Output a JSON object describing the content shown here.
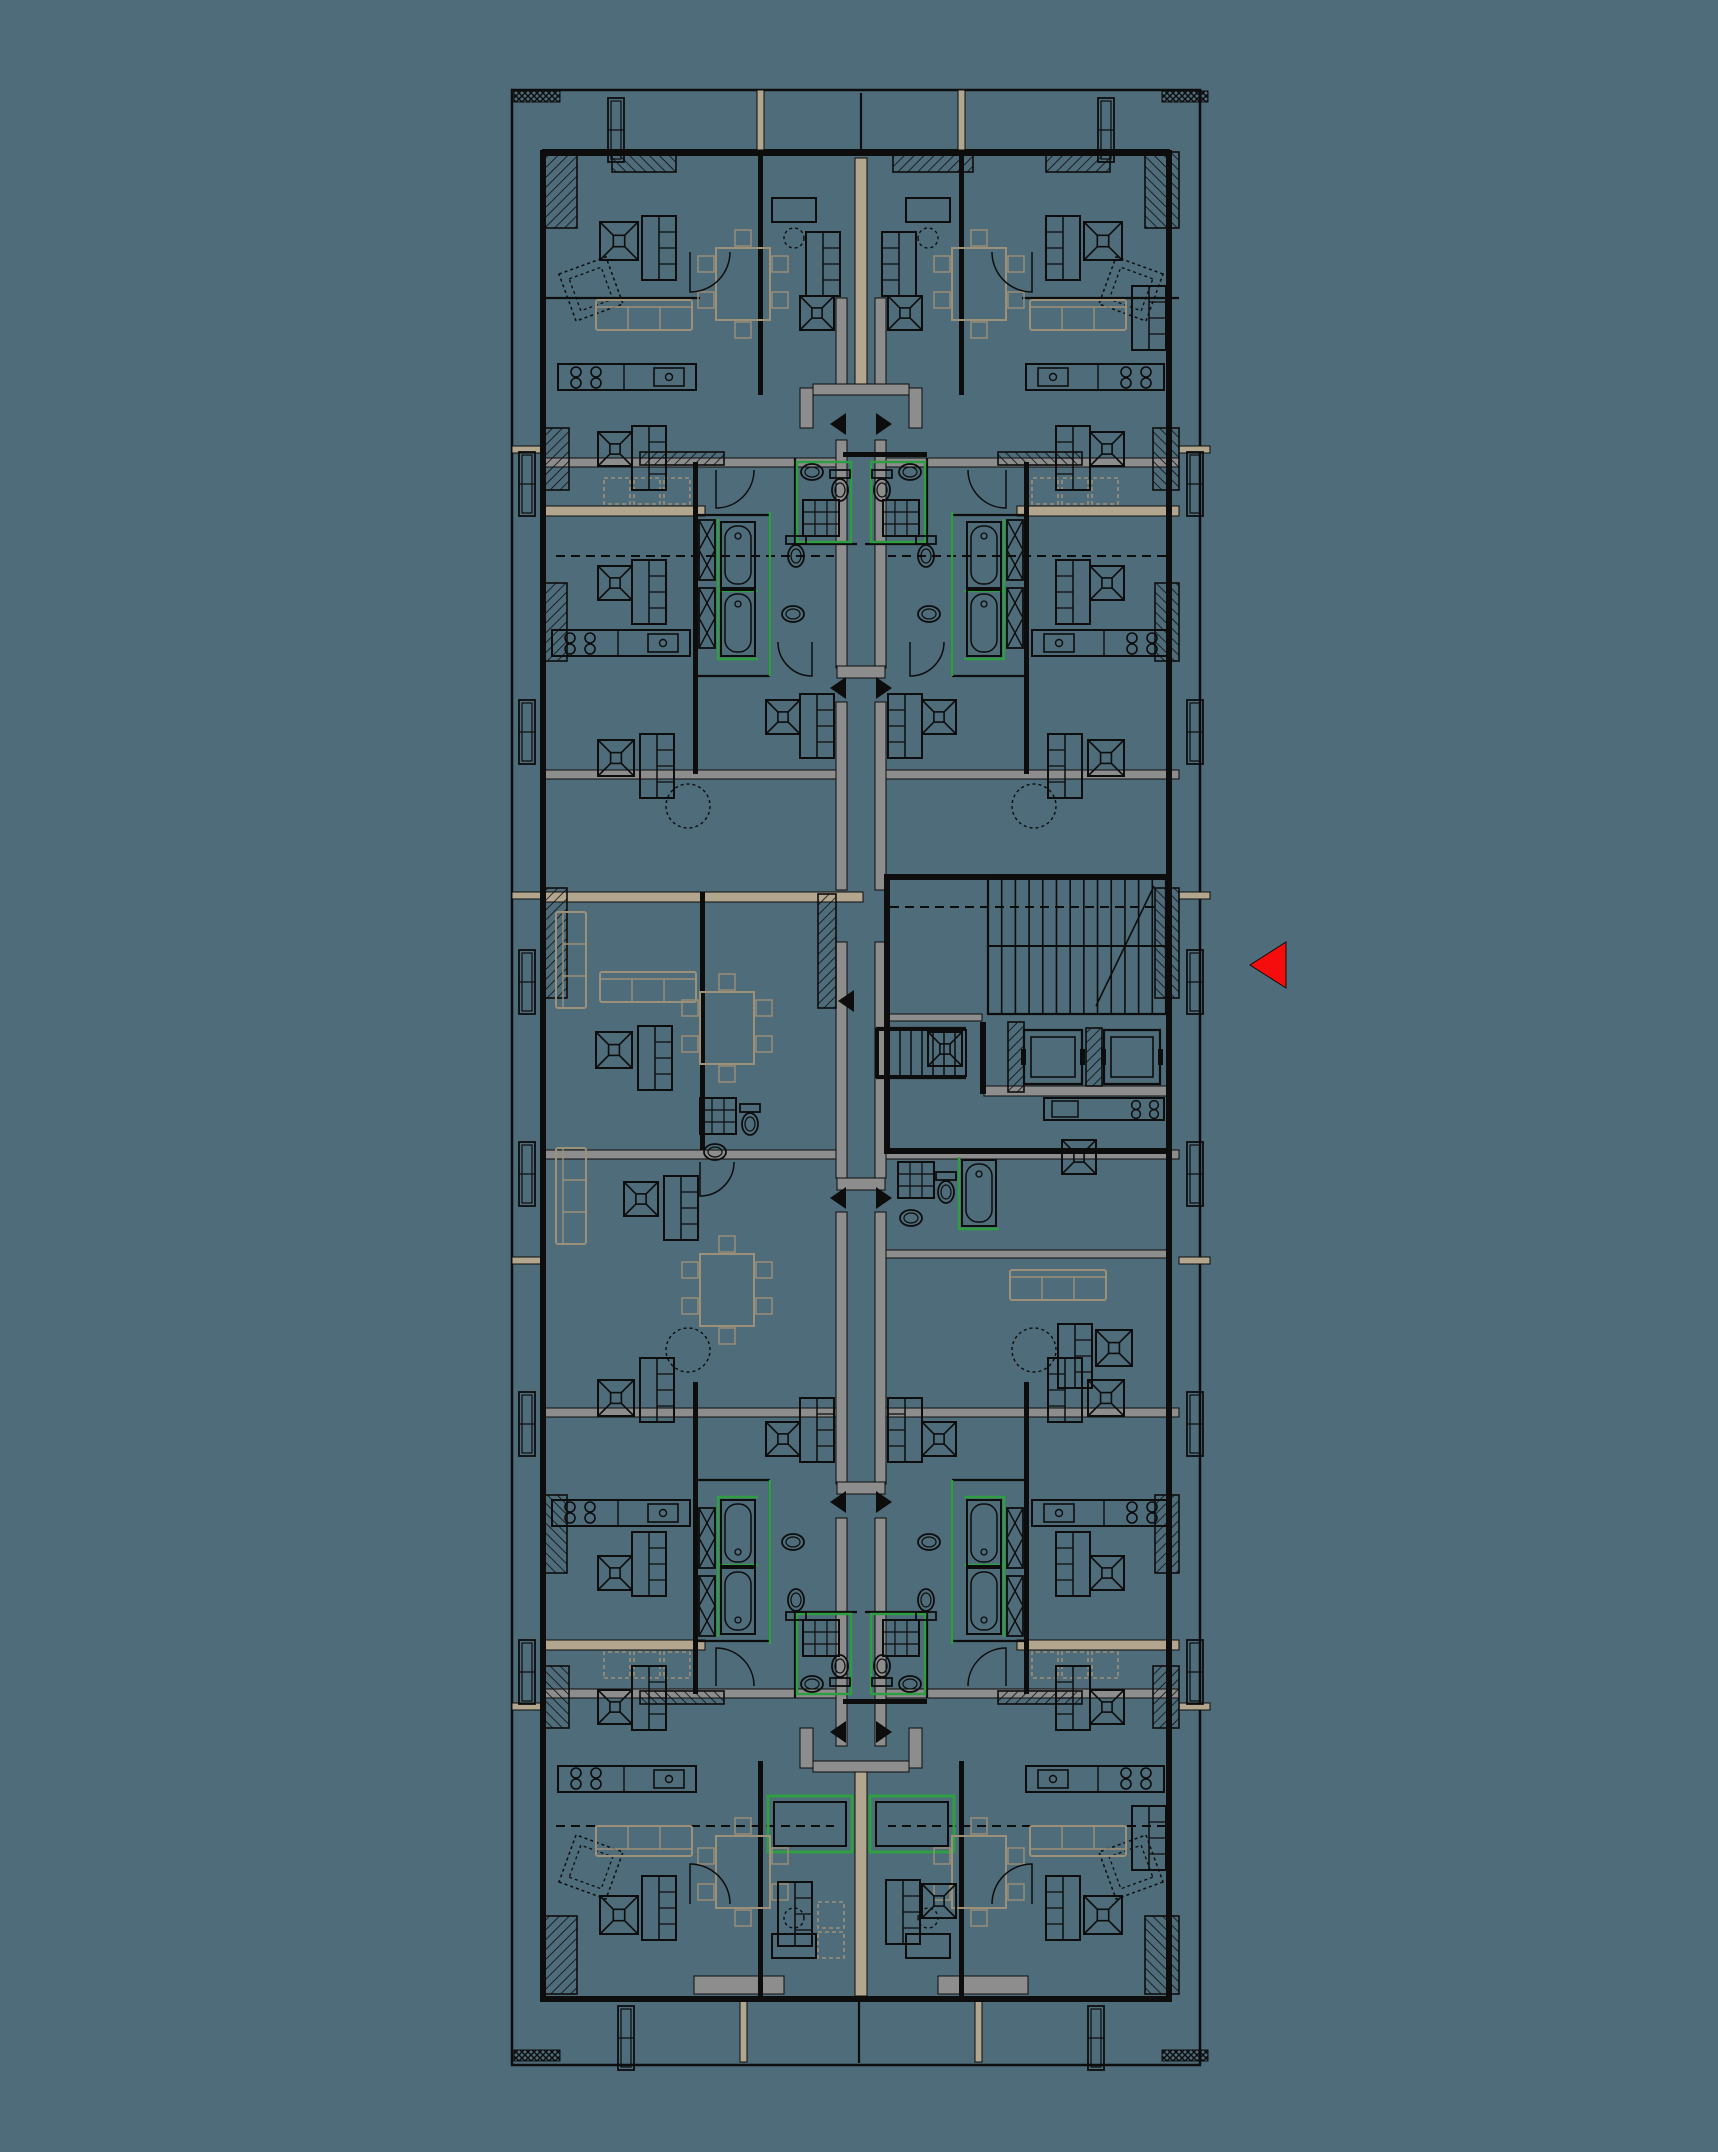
{
  "canvas": {
    "width": 1718,
    "height": 2152,
    "background": "#4e6c7a"
  },
  "palette": {
    "line": "#0d0d0d",
    "wall_gray": "#8d8d8d",
    "wall_tan": "#b2a68e",
    "furniture_tan": "#9d9078",
    "accent_green": "#2f9e43",
    "marker_red": "#f50d0d"
  },
  "mirror": {
    "axis_x": 861,
    "axis_y": 1078,
    "width2": 1722,
    "height2": 2156
  },
  "building": {
    "outer": [
      512,
      90,
      688,
      1975
    ],
    "inner": [
      543,
      150,
      626,
      1848
    ]
  },
  "walls": {
    "black": [
      [
        543,
        150,
        626,
        6
      ],
      [
        543,
        1996,
        626,
        6
      ],
      [
        540,
        150,
        6,
        1852
      ],
      [
        1166,
        150,
        6,
        1852
      ],
      [
        693,
        462,
        5,
        312,
        "4"
      ],
      [
        758,
        155,
        5,
        240,
        "4"
      ],
      [
        843,
        452,
        84,
        5,
        "y"
      ],
      [
        886,
        874,
        282,
        6
      ],
      [
        886,
        1148,
        282,
        6
      ],
      [
        884,
        874,
        6,
        280
      ],
      [
        980,
        1022,
        6,
        72
      ],
      [
        700,
        892,
        5,
        258
      ]
    ],
    "gray": [
      [
        543,
        458,
        300,
        9,
        "4"
      ],
      [
        543,
        770,
        300,
        9,
        "x"
      ],
      [
        543,
        1150,
        300,
        9,
        "x"
      ],
      [
        543,
        1408,
        300,
        9,
        "x"
      ],
      [
        836,
        298,
        11,
        90,
        "x"
      ],
      [
        836,
        440,
        11,
        228,
        "x"
      ],
      [
        836,
        702,
        11,
        188,
        "x"
      ],
      [
        836,
        942,
        11,
        236,
        "x"
      ],
      [
        836,
        1212,
        11,
        272,
        "x"
      ],
      [
        836,
        1518,
        11,
        228,
        "x"
      ],
      [
        800,
        388,
        13,
        40,
        "4"
      ],
      [
        813,
        384,
        96,
        11,
        "y"
      ],
      [
        984,
        1086,
        184,
        10
      ],
      [
        886,
        1014,
        96,
        7
      ],
      [
        886,
        1250,
        282,
        8
      ],
      [
        694,
        1976,
        90,
        18
      ],
      [
        938,
        1976,
        90,
        18
      ],
      [
        837,
        666,
        48,
        12
      ],
      [
        837,
        1178,
        48,
        12
      ],
      [
        837,
        1482,
        48,
        12
      ]
    ],
    "tan": [
      [
        855,
        158,
        12,
        230
      ],
      [
        855,
        1772,
        12,
        224
      ],
      [
        543,
        506,
        162,
        10,
        "4"
      ],
      [
        543,
        892,
        320,
        10
      ],
      [
        512,
        446,
        31,
        7,
        "4"
      ],
      [
        512,
        892,
        31,
        7,
        "4"
      ],
      [
        757,
        90,
        7,
        60,
        "x"
      ],
      [
        740,
        1998,
        7,
        64,
        "x"
      ]
    ],
    "hatched": [
      [
        543,
        152,
        34,
        76,
        "x"
      ],
      [
        543,
        428,
        26,
        62,
        "4"
      ],
      [
        543,
        583,
        24,
        78,
        "4"
      ],
      [
        543,
        888,
        24,
        110,
        "x"
      ],
      [
        543,
        1916,
        34,
        78,
        "x"
      ],
      [
        640,
        452,
        84,
        13,
        "4"
      ],
      [
        893,
        152,
        80,
        20
      ],
      [
        1046,
        152,
        64,
        20,
        "x"
      ],
      [
        1008,
        1022,
        16,
        70
      ],
      [
        1086,
        1028,
        16,
        58
      ],
      [
        818,
        894,
        18,
        114
      ]
    ],
    "ticks": [
      [
        514,
        91,
        46,
        11,
        "x"
      ],
      [
        514,
        2050,
        46,
        11,
        "x"
      ]
    ],
    "lines": [
      [
        543,
        298,
        700,
        298,
        "x"
      ],
      [
        795,
        458,
        795,
        544,
        "4"
      ],
      [
        795,
        544,
        857,
        544,
        "4"
      ],
      [
        698,
        515,
        770,
        515,
        "4"
      ],
      [
        770,
        515,
        770,
        676,
        "4"
      ],
      [
        698,
        676,
        770,
        676,
        "4"
      ],
      [
        876,
        1028,
        966,
        1028
      ],
      [
        876,
        1078,
        966,
        1078
      ],
      [
        876,
        1028,
        876,
        1078
      ],
      [
        861,
        93,
        861,
        150
      ],
      [
        859,
        2002,
        859,
        2063
      ]
    ],
    "dashed": [
      [
        556,
        556,
        834,
        556,
        "x"
      ],
      [
        556,
        1826,
        834,
        1826,
        "x"
      ],
      [
        890,
        907,
        1160,
        907
      ]
    ]
  },
  "green": {
    "rooms": [
      [
        797,
        462,
        54,
        80,
        "4"
      ]
    ],
    "lines": [
      [
        770,
        512,
        770,
        676,
        "4"
      ]
    ],
    "loggias": [
      [
        768,
        1796,
        84,
        56
      ],
      [
        870,
        1796,
        84,
        56
      ]
    ]
  },
  "core": {
    "stair_main": {
      "x": 988,
      "y": 878,
      "w": 178,
      "h": 136,
      "treads": 12
    },
    "stair_small": {
      "x": 878,
      "y": 1030,
      "w": 88,
      "h": 46,
      "treads": 7
    },
    "elevators": [
      [
        1024,
        1030,
        58,
        54
      ],
      [
        1104,
        1030,
        56,
        54
      ]
    ]
  },
  "arrows": {
    "pairs_y": [
      424,
      688,
      1198,
      1502,
      1732
    ],
    "single": {
      "x": 846,
      "y": 1001
    },
    "half_w": 16,
    "half_h": 11,
    "cx": 861,
    "inner_gap": 15
  },
  "view_marker": {
    "points": [
      [
        1286,
        942
      ],
      [
        1286,
        988
      ],
      [
        1250,
        965
      ]
    ]
  },
  "furniture": [
    {
      "t": "frustum",
      "x": 600,
      "y": 222,
      "s": 38,
      "f": "4"
    },
    {
      "t": "wardrobe",
      "x": 642,
      "y": 216,
      "f": "4"
    },
    {
      "t": "chair_d",
      "x": 566,
      "y": 264,
      "r": -20,
      "f": "4"
    },
    {
      "t": "sofa_h",
      "x": 596,
      "y": 300,
      "f": "4"
    },
    {
      "t": "table",
      "x": 716,
      "y": 248,
      "f": "4"
    },
    {
      "t": "desk",
      "x": 772,
      "y": 198,
      "f": "4"
    },
    {
      "t": "kitchen",
      "x": 558,
      "y": 364,
      "f": "4"
    },
    {
      "t": "closet_d",
      "x": 604,
      "y": 478,
      "f": "4"
    },
    {
      "t": "closet_d",
      "x": 634,
      "y": 478,
      "f": "4"
    },
    {
      "t": "closet_d",
      "x": 664,
      "y": 478,
      "f": "4"
    },
    {
      "t": "frustum",
      "x": 598,
      "y": 432,
      "s": 34,
      "f": "4"
    },
    {
      "t": "wardrobe",
      "x": 632,
      "y": 426,
      "f": "4"
    },
    {
      "t": "frustum",
      "x": 598,
      "y": 566,
      "s": 34,
      "f": "4"
    },
    {
      "t": "wardrobe",
      "x": 632,
      "y": 560,
      "f": "4"
    },
    {
      "t": "shaftx",
      "x": 699,
      "y": 520,
      "f": "4"
    },
    {
      "t": "tub",
      "x": 721,
      "y": 522,
      "f": "4"
    },
    {
      "t": "shaftx",
      "x": 699,
      "y": 588,
      "f": "4"
    },
    {
      "t": "tub",
      "x": 721,
      "y": 590,
      "f": "4"
    },
    {
      "t": "wc",
      "x": 786,
      "y": 536,
      "f": "4"
    },
    {
      "t": "basin",
      "x": 782,
      "y": 606,
      "f": "4"
    },
    {
      "t": "basin",
      "x": 801,
      "y": 464,
      "f": "4"
    },
    {
      "t": "wc",
      "x": 830,
      "y": 470,
      "f": "4"
    },
    {
      "t": "shower",
      "x": 803,
      "y": 500,
      "f": "4"
    },
    {
      "t": "frustum",
      "x": 598,
      "y": 740,
      "s": 36,
      "f": "4"
    },
    {
      "t": "wardrobe",
      "x": 640,
      "y": 734,
      "f": "4"
    },
    {
      "t": "circle_d",
      "x": 666,
      "y": 784,
      "f": "4"
    },
    {
      "t": "frustum",
      "x": 766,
      "y": 700,
      "s": 34,
      "f": "4"
    },
    {
      "t": "wardrobe",
      "x": 800,
      "y": 694,
      "f": "4"
    },
    {
      "t": "kitchen",
      "x": 552,
      "y": 630,
      "f": "4"
    },
    {
      "t": "sofa_v",
      "x": 556,
      "y": 912,
      "f": "y"
    },
    {
      "t": "table",
      "x": 700,
      "y": 992
    },
    {
      "t": "table",
      "x": 700,
      "y": 1254
    },
    {
      "t": "frustum",
      "x": 596,
      "y": 1032,
      "s": 36
    },
    {
      "t": "wardrobe",
      "x": 638,
      "y": 1026
    },
    {
      "t": "sofa_h",
      "x": 600,
      "y": 972
    },
    {
      "t": "shower",
      "x": 700,
      "y": 1098
    },
    {
      "t": "wc",
      "x": 740,
      "y": 1104
    },
    {
      "t": "basin",
      "x": 704,
      "y": 1144
    },
    {
      "t": "frustum",
      "x": 624,
      "y": 1182,
      "s": 34
    },
    {
      "t": "wardrobe",
      "x": 664,
      "y": 1176
    },
    {
      "t": "frustum",
      "x": 928,
      "y": 1032,
      "s": 34
    },
    {
      "t": "kitchen_s",
      "x": 1044,
      "y": 1098
    },
    {
      "t": "frustum",
      "x": 1062,
      "y": 1140,
      "s": 34
    },
    {
      "t": "shower",
      "x": 898,
      "y": 1162
    },
    {
      "t": "wc",
      "x": 936,
      "y": 1172
    },
    {
      "t": "basin",
      "x": 900,
      "y": 1210
    },
    {
      "t": "tub",
      "x": 962,
      "y": 1160
    },
    {
      "t": "wardrobe",
      "x": 1132,
      "y": 286,
      "f": "y"
    },
    {
      "t": "sofa_h",
      "x": 1010,
      "y": 1270
    },
    {
      "t": "wardrobe",
      "x": 1058,
      "y": 1324
    },
    {
      "t": "frustum",
      "x": 1096,
      "y": 1330,
      "s": 36
    },
    {
      "t": "wardrobe",
      "x": 806,
      "y": 232,
      "f": "x"
    },
    {
      "t": "frustum",
      "x": 800,
      "y": 296,
      "s": 34,
      "f": "x"
    },
    {
      "t": "wardrobe",
      "x": 778,
      "y": 1882
    },
    {
      "t": "wardrobe",
      "x": 886,
      "y": 1880
    },
    {
      "t": "frustum",
      "x": 922,
      "y": 1884,
      "s": 34
    },
    {
      "t": "closet_d",
      "x": 818,
      "y": 1902
    },
    {
      "t": "closet_d",
      "x": 818,
      "y": 1932
    },
    {
      "t": "planter",
      "x": 519,
      "y": 452,
      "f": "4"
    },
    {
      "t": "planter",
      "x": 519,
      "y": 700,
      "f": "4"
    },
    {
      "t": "planter",
      "x": 519,
      "y": 950,
      "f": "4"
    },
    {
      "t": "planter",
      "x": 608,
      "y": 98,
      "f": "x"
    },
    {
      "t": "planter",
      "x": 618,
      "y": 2006,
      "f": "x"
    }
  ],
  "door_arcs": [
    {
      "x": 690,
      "y": 252,
      "r": 40,
      "f": "4"
    },
    {
      "x": 716,
      "y": 470,
      "r": 38,
      "f": "4"
    },
    {
      "x": 700,
      "y": 1162,
      "r": 34
    },
    {
      "x": 910,
      "y": 642,
      "r": 34,
      "f": "x"
    }
  ]
}
